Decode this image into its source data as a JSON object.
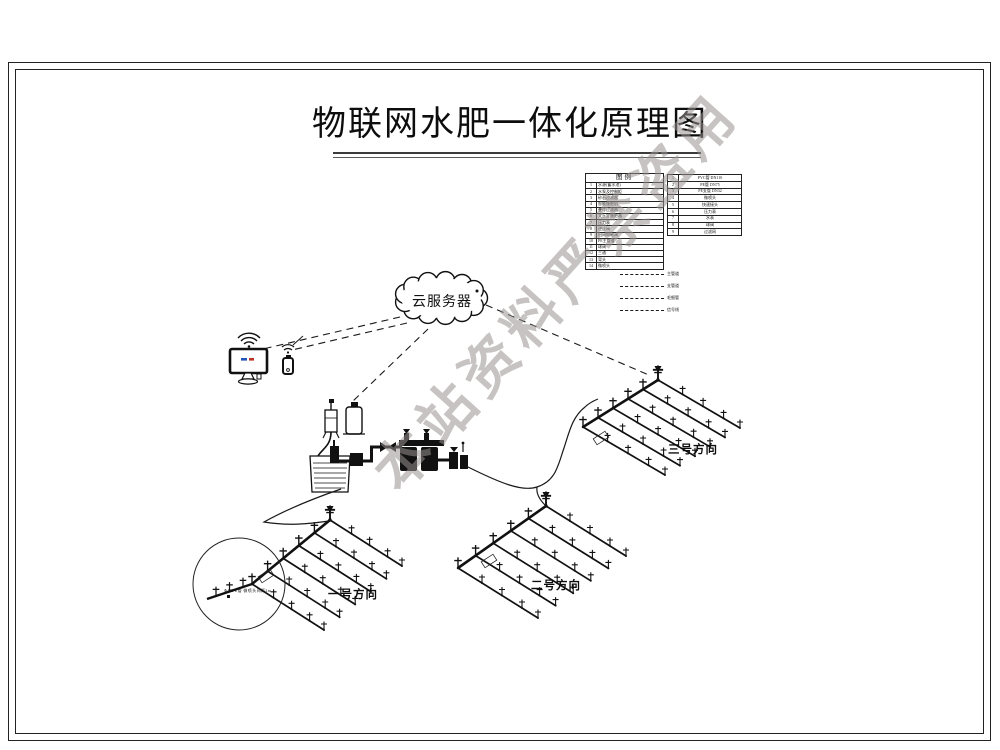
{
  "title": "物联网水肥一体化原理图",
  "watermark": "本站资料严禁盗用",
  "cloud": {
    "label": "云服务器"
  },
  "legend": {
    "title": "图例",
    "left_rows": [
      {
        "no": "1",
        "label": "水源(蓄水池)"
      },
      {
        "no": "2",
        "label": "水泵及控制柜"
      },
      {
        "no": "3",
        "label": "砂石过滤器"
      },
      {
        "no": "4",
        "label": "智能施肥机"
      },
      {
        "no": "5",
        "label": "叠片过滤器"
      },
      {
        "no": "6",
        "label": "文丘里施肥器"
      },
      {
        "no": "7",
        "label": "压力表"
      },
      {
        "no": "8",
        "label": "逆止阀"
      },
      {
        "no": "9",
        "label": "田间电磁阀"
      },
      {
        "no": "10",
        "label": "PE主管道"
      },
      {
        "no": "11",
        "label": "球阀"
      },
      {
        "no": "12",
        "label": "三通"
      },
      {
        "no": "13",
        "label": "弯头"
      },
      {
        "no": "14",
        "label": "微喷头"
      }
    ],
    "right_rows": [
      {
        "no": "1",
        "label": "PVC管 DN110"
      },
      {
        "no": "2",
        "label": "PE管 DN75"
      },
      {
        "no": "3",
        "label": "PE支管 DN32"
      },
      {
        "no": "4",
        "label": "微喷头"
      },
      {
        "no": "5",
        "label": "快速接头"
      },
      {
        "no": "6",
        "label": "压力表"
      },
      {
        "no": "7",
        "label": "水表"
      },
      {
        "no": "8",
        "label": "球阀"
      },
      {
        "no": "9",
        "label": "过滤网"
      }
    ],
    "line_rows": [
      "主管道",
      "支管道",
      "毛细管",
      "信号线"
    ]
  },
  "fields": [
    {
      "label": "一号方向"
    },
    {
      "label": "二号方向"
    },
    {
      "label": "三号方向"
    }
  ],
  "detail_note": "Φ40PE管 微喷头间距2m",
  "colors": {
    "line": "#1a1a1a",
    "watermark": "#98928f",
    "screen_blue": "#2255bb",
    "screen_red": "#bb3322"
  }
}
